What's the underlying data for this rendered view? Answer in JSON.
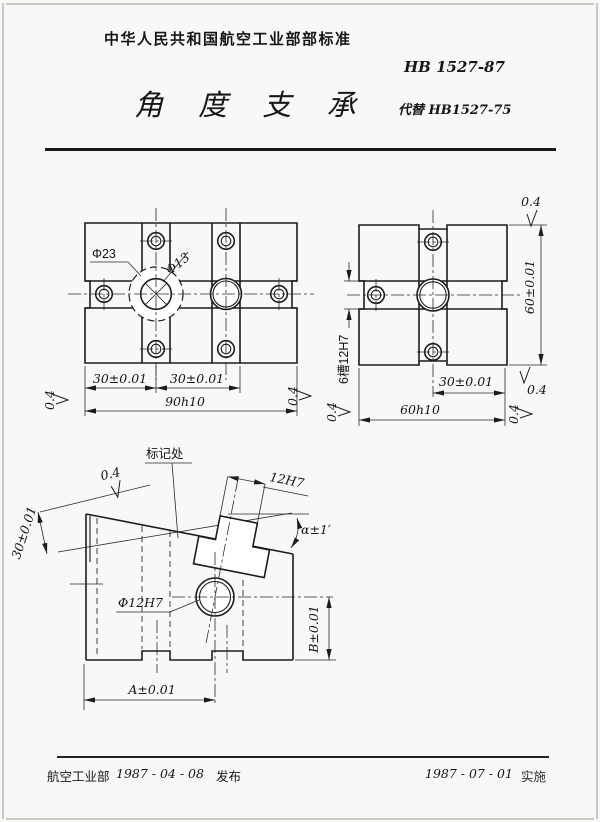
{
  "header": {
    "org_line": "中华人民共和国航空工业部部标准",
    "standard_no": "HB 1527-87",
    "title": "角 度 支 承",
    "replaces": "代替 HB1527-75"
  },
  "footer": {
    "org": "航空工业部",
    "release_date": "1987 - 04 - 08",
    "release_label": "发布",
    "impl_date": "1987 - 07 - 01",
    "impl_label": "实施"
  },
  "front_view": {
    "counterbore_dia": "Φ23",
    "hole_dia": "Φ13",
    "dim_30_left": "30±0.01",
    "dim_30_right": "30±0.01",
    "dim_width": "90h10",
    "finish_left": "0.4",
    "finish_right": "0.4"
  },
  "side_view": {
    "slot_note": "6槽12H7",
    "dim_height": "60±0.01",
    "dim_30": "30±0.01",
    "dim_width": "60h10",
    "finish_top": "0.4",
    "finish_right": "0.4",
    "finish_bottom_right": "0.4",
    "finish_bottom_left": "0.4"
  },
  "section_view": {
    "mark_note": "标记处",
    "slot_dim": "12H7",
    "angle_dim": "α±1′",
    "dim_30": "30±0.01",
    "hole_dim": "Φ12H7",
    "dim_a": "A±0.01",
    "dim_b": "B±0.01",
    "finish_top": "0.4"
  }
}
